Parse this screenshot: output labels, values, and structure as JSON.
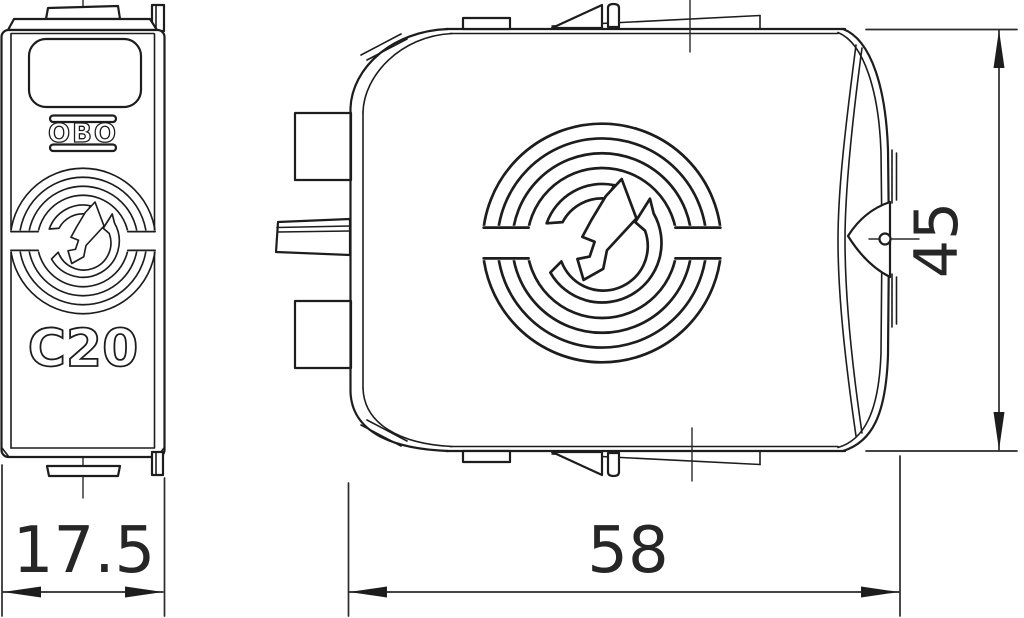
{
  "front_view": {
    "brand_logo": "OBO",
    "type_marking": "C20"
  },
  "dimensions": {
    "front_width_mm": "17.5",
    "side_width_mm": "58",
    "height_mm": "45"
  },
  "colors": {
    "line": "#1d1d1d",
    "background": "#ffffff"
  }
}
